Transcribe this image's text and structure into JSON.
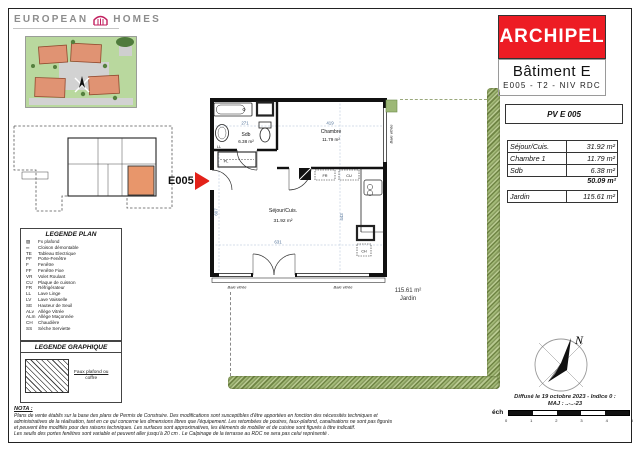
{
  "logo": {
    "left": "EUROPEAN",
    "right": "HOMES"
  },
  "title_block": {
    "project": "ARCHIPEL",
    "building": "Bâtiment E",
    "unit": "E005 - T2 - NIV  RDC",
    "pv": "PV E 005",
    "rows": [
      {
        "label": "Séjour/Cuis.",
        "value": "31.92 m²"
      },
      {
        "label": "Chambre 1",
        "value": "11.79 m²"
      },
      {
        "label": "Sdb",
        "value": "6.38 m²"
      }
    ],
    "total": "50.09 m²",
    "garden_label": "Jardin",
    "garden_value": "115.61 m²"
  },
  "plan": {
    "unit": "E005",
    "sdb_name": "Sdb",
    "sdb_area": "6.38 m²",
    "chambre_name": "Chambre",
    "chambre_area": "11.79 m²",
    "sejour_name": "Séjour/Cuis.",
    "sejour_area": "31.92 m²",
    "garden_area": "115.61 m²",
    "garden_name": "Jardin",
    "dim_sdb": "271",
    "dim_chambre": "419",
    "dim_sejour_w": "631",
    "dim_sejour_h": "443",
    "dim_left_h": "607",
    "lbl_ll": "LL",
    "lbl_pl": "PL",
    "lbl_fr": "FR",
    "lbl_cu": "CU",
    "lbl_ch": "CH",
    "baie_vitree": "Baie vitrée"
  },
  "legend_plan": {
    "title": "LEGENDE PLAN",
    "items": [
      {
        "code": "▨",
        "label": "Fx plafond"
      },
      {
        "code": "═",
        "label": "Cloison démontable"
      },
      {
        "code": "TE",
        "label": "Tableau Electrique"
      },
      {
        "code": "PF",
        "label": "Porte-Fenêtre"
      },
      {
        "code": "F",
        "label": "Fenêtre"
      },
      {
        "code": "FF",
        "label": "Fenêtre Fixe"
      },
      {
        "code": "VR",
        "label": "Volet Roulant"
      },
      {
        "code": "CU",
        "label": "Plaque de cuisson"
      },
      {
        "code": "FR",
        "label": "Réfrigérateur"
      },
      {
        "code": "LL",
        "label": "Lave Linge"
      },
      {
        "code": "LV",
        "label": "Lave Vaisselle"
      },
      {
        "code": "SE",
        "label": "Hauteur de Seuil"
      },
      {
        "code": "ALv",
        "label": "Allège Vitrée"
      },
      {
        "code": "ALm",
        "label": "Allège Maçonnée"
      },
      {
        "code": "CH",
        "label": "Chaudière"
      },
      {
        "code": "SS",
        "label": "Sèche Serviette"
      }
    ]
  },
  "legend_graph": {
    "title": "LEGENDE GRAPHIQUE",
    "line1": "Faux plafond ou",
    "line2": "coffre"
  },
  "nota": {
    "title": "NOTA :",
    "lines": [
      "Plans de vente établis sur la base des plans de Permis de Construire. Des modifications sont susceptibles d'être apportées en fonction des nécessités techniques et",
      "administratives de la réalisation, tant en ce qui concerne les dimensions libres que l'équipement. Les retombées de poutres, faux-plafond, canalisations ne sont pas figurés",
      "et peuvent être modifiés pour des raisons techniques. Les surfaces sont approximatives, les éléments de mobilier et de cuisine sont figurés à titre indicatif.",
      "Les seuils des portes fenêtres sont variable et peuvent aller jusqu'à 20 cm . Le Calpinage de la terrasse au RDC ne sera pas celui représenté ."
    ]
  },
  "footer": {
    "diffusion": "Diffusé le 19 octobre 2023 - Indice 0 :",
    "maj": "MAJ : ..-..-23",
    "ech": "éch",
    "ticks": [
      "0",
      "1",
      "2",
      "3",
      "4",
      "5"
    ]
  },
  "compass_n": "N"
}
